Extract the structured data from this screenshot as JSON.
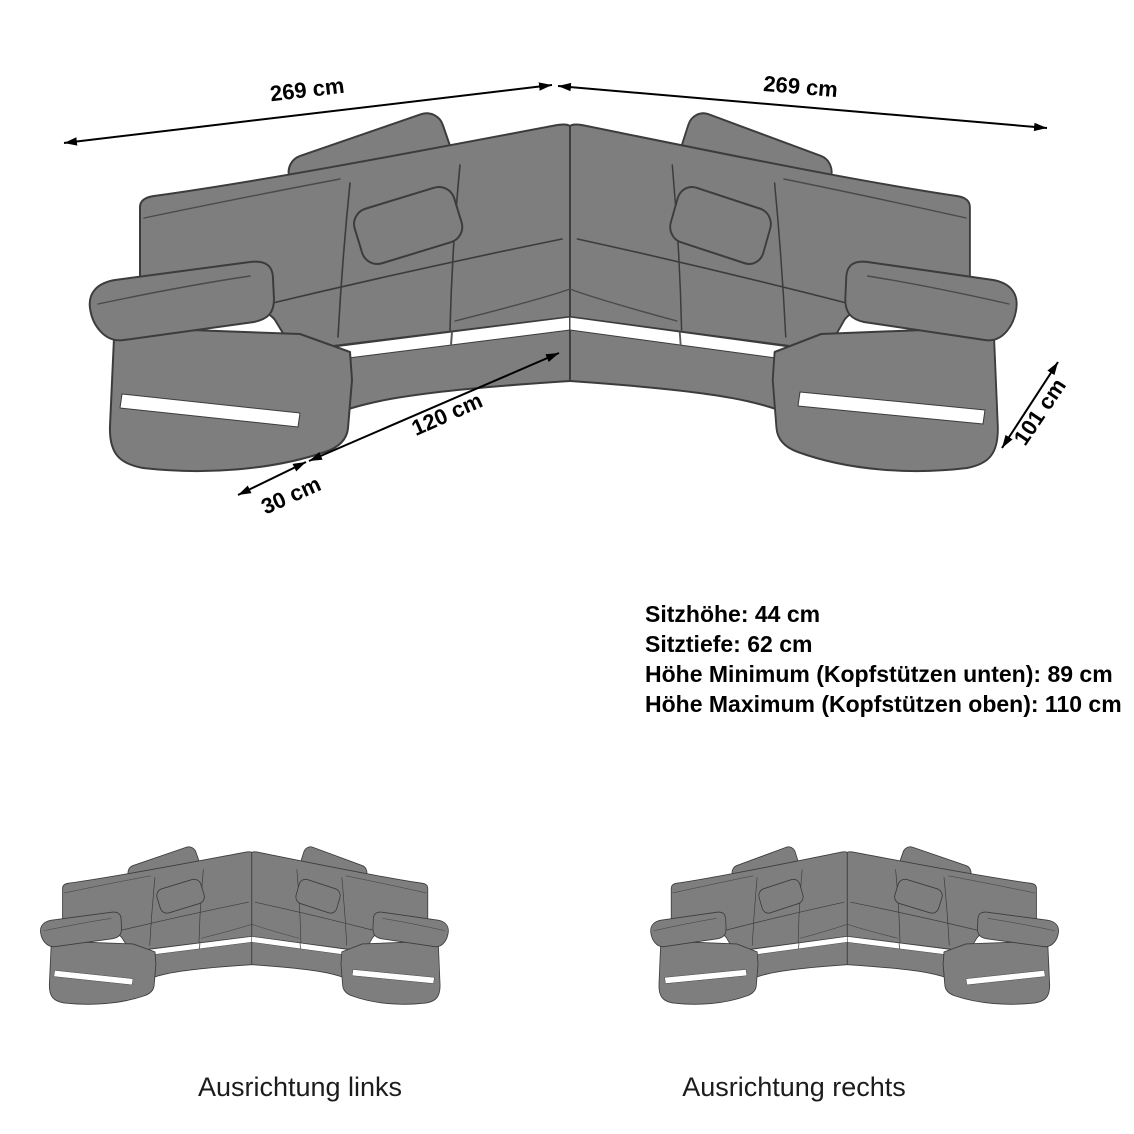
{
  "palette": {
    "background": "#ffffff",
    "sofa_fill": "#7e7e7e",
    "sofa_outline": "#3c3c3c",
    "led_stripe": "#ffffff",
    "dimension_color": "#000000",
    "variant_label_color": "#1c1c1c"
  },
  "main_diagram": {
    "dimensions": {
      "back_left": "269 cm",
      "back_right": "269 cm",
      "seat_front": "120 cm",
      "arm_front": "30 cm",
      "side_depth": "101 cm"
    },
    "specs": [
      "Sitzhöhe: 44 cm",
      "Sitztiefe: 62 cm",
      "Höhe Minimum (Kopfstützen unten): 89 cm",
      "Höhe Maximum (Kopfstützen oben): 110 cm"
    ]
  },
  "variants": {
    "left_label": "Ausrichtung links",
    "right_label": "Ausrichtung rechts"
  }
}
